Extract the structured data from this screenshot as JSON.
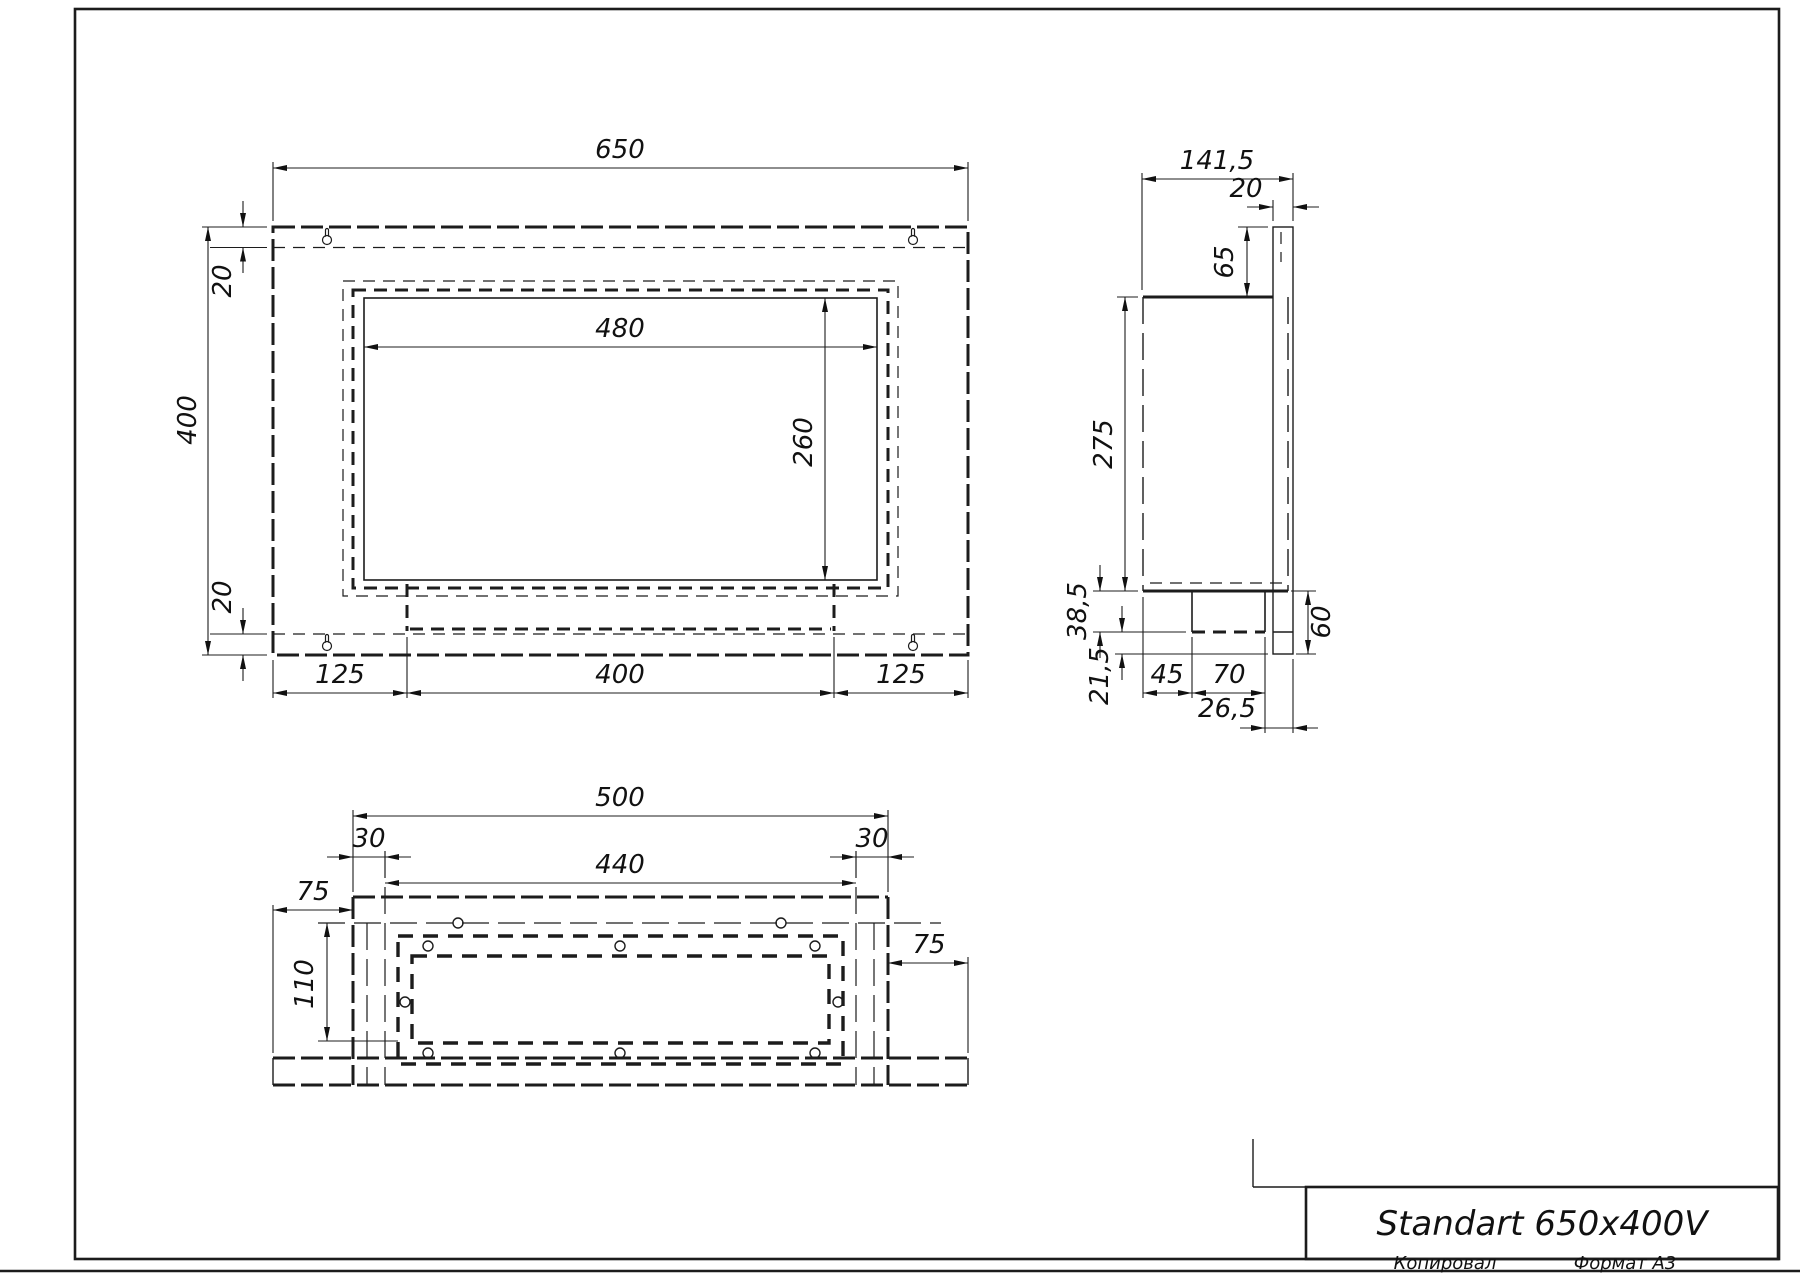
{
  "front": {
    "width": "650",
    "height": "400",
    "offset_top": "20",
    "offset_bottom": "20",
    "opening_width": "480",
    "opening_height": "260",
    "margin_left": "125",
    "burner_width": "400",
    "margin_right": "125"
  },
  "side": {
    "depth": "141,5",
    "plate_thickness": "20",
    "tab_height": "65",
    "body_height": "275",
    "burner_drop": "38,5",
    "bottom_gap": "21,5",
    "burner_front": "45",
    "burner_depth": "70",
    "burner_back": "26,5",
    "flange_height": "60"
  },
  "bottom": {
    "box_width": "500",
    "inset_left": "30",
    "opening_width": "440",
    "inset_right": "30",
    "flange_left": "75",
    "depth": "110",
    "flange_right": "75"
  },
  "title_block": {
    "title": "Standart 650x400V",
    "footer_left": "Копировал",
    "footer_right": "Формат А3"
  }
}
